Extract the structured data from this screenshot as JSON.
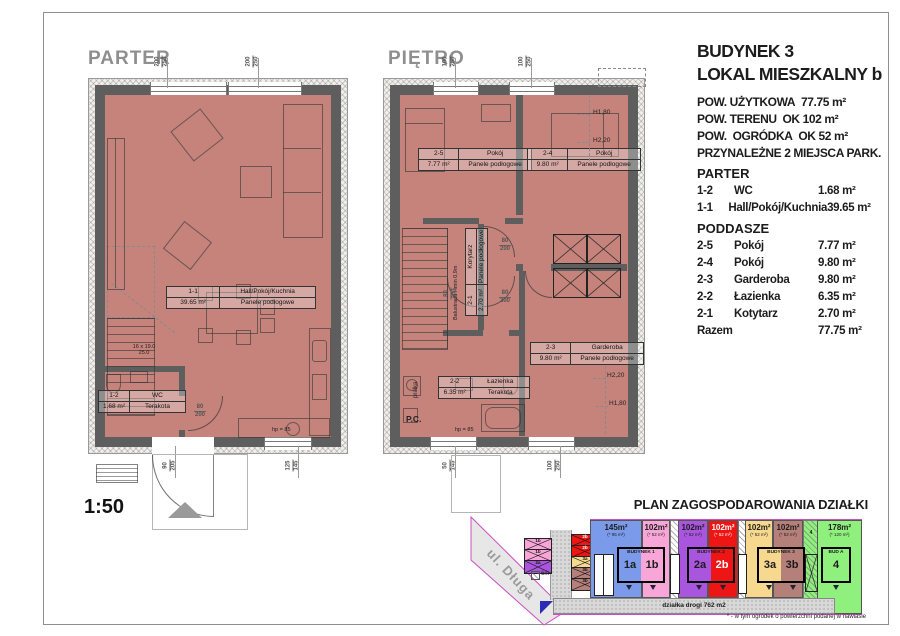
{
  "scale_label": "1:50",
  "colors": {
    "floor_fill": "#c5837c",
    "wall": "#5e5e5e",
    "boundary_magenta": "#cc4fc2",
    "parcel_blue": "#7b9bea",
    "parcel_pink": "#f8a6d8",
    "parcel_purple": "#aa55dd",
    "parcel_red": "#ee1515",
    "parcel_yellow": "#f6d98e",
    "parcel_brown": "#b57f7a",
    "parcel_green": "#8ff07d"
  },
  "parter": {
    "title": "PARTER",
    "rooms": {
      "hall": {
        "code": "1-1",
        "name": "Hall/Pokój/Kuchnia",
        "area": "39.65 m²",
        "finish": "Panele podłogowe"
      },
      "wc": {
        "code": "1-2",
        "name": "WC",
        "area": "1.68 m²",
        "finish": "Terakota"
      }
    },
    "dims": {
      "top1": {
        "t": "200",
        "b": "250"
      },
      "top2": {
        "t": "200",
        "b": "250"
      },
      "bottom1": {
        "t": "90",
        "b": "205"
      },
      "bottom2": {
        "t": "125",
        "b": "145"
      },
      "door_wc": {
        "t": "80",
        "b": "200"
      }
    },
    "stairs_note": {
      "line1": "16 x 19.0",
      "line2": "25.0"
    },
    "hp_label": "hp = 85"
  },
  "pietro": {
    "title": "PIĘTRO",
    "rooms": {
      "r25": {
        "code": "2-5",
        "name": "Pokój",
        "area": "7.77 m²",
        "finish": "Panele podłogowe"
      },
      "r24": {
        "code": "2-4",
        "name": "Pokój",
        "area": "9.80 m²",
        "finish": "Panele podłogowe"
      },
      "r23": {
        "code": "2-3",
        "name": "Garderoba",
        "area": "9.80 m²",
        "finish": "Panele podłogowe"
      },
      "r22": {
        "code": "2-2",
        "name": "Łazienka",
        "area": "6.35 m²",
        "finish": "Terakota"
      },
      "r21": {
        "code": "2-1",
        "name": "Korytarz",
        "area": "2.70 m²",
        "finish": "Panele podłogowe"
      }
    },
    "dims": {
      "top1": {
        "t": "100",
        "b": "250"
      },
      "top2": {
        "t": "100",
        "b": "250"
      },
      "bottom1": {
        "t": "50",
        "b": "145"
      },
      "bottom2": {
        "t": "100",
        "b": "250"
      },
      "door1": {
        "t": "80",
        "b": "200"
      },
      "door2": {
        "t": "80",
        "b": "200"
      },
      "door3": {
        "t": "80",
        "b": "200"
      }
    },
    "h_top1": "H1,80",
    "h_top2": "H2,20",
    "h_bot1": "H2,20",
    "h_bot2": "H1,80",
    "balustrada": "Balustrada Hmin 0,9m",
    "pralka": "pralka",
    "pc": "P.C.",
    "hp_label": "hp = 85"
  },
  "info": {
    "building": "BUDYNEK 3",
    "unit": "LOKAL MIESZKALNY b",
    "specs": [
      "POW. UŻYTKOWA  77.75 m²",
      "POW. TERENU  OK 102 m²",
      "POW.  OGRÓDKA  OK 52 m²",
      "PRZYNALEŻNE 2 MIEJSCA PARK."
    ],
    "section_parter": "PARTER",
    "rows_parter": [
      {
        "code": "1-2",
        "name": "WC",
        "area": "1.68 m²"
      },
      {
        "code": "1-1",
        "name": "Hall/Pokój/Kuchnia",
        "area": "39.65 m²"
      }
    ],
    "section_poddasze": "PODDASZE",
    "rows_poddasze": [
      {
        "code": "2-5",
        "name": "Pokój",
        "area": "7.77 m²"
      },
      {
        "code": "2-4",
        "name": "Pokój",
        "area": "9.80 m²"
      },
      {
        "code": "2-3",
        "name": "Garderoba",
        "area": "9.80 m²"
      },
      {
        "code": "2-2",
        "name": "Łazienka",
        "area": "6.35 m²"
      },
      {
        "code": "2-1",
        "name": "Kotytarz",
        "area": "2.70 m²"
      }
    ],
    "total_label": "Razem",
    "total_area": "77.75 m²"
  },
  "siteplan": {
    "title": "PLAN ZAGOSPODAROWANIA DZIAŁKI",
    "street": "ul. Długa",
    "road_label": "działka drogi 762 m2",
    "width_label": "6m",
    "footnote": "* - w tym ogródek o powierzchni podanej w nawiasie",
    "parcels": [
      {
        "area": "145m²",
        "sub": "(* 95 m²)"
      },
      {
        "area": "102m²",
        "sub": "(* 52 m²)"
      },
      {
        "area": "102m²",
        "sub": "(* 52 m²)"
      },
      {
        "area": "102m²",
        "sub": "(* 52 m²)"
      },
      {
        "area": "102m²",
        "sub": "(* 52 m²)"
      },
      {
        "area": "102m²",
        "sub": "(* 52 m²)"
      },
      {
        "area": "178m²",
        "sub": "(* 120 m²)"
      }
    ],
    "buildings": [
      {
        "name": "BUDYNEK 1",
        "u1": "1a",
        "u2": "1b"
      },
      {
        "name": "BUDYNEK 2",
        "u1": "2a",
        "u2": "2b"
      },
      {
        "name": "BUDYNEK 3",
        "u1": "3a",
        "u2": "3b"
      },
      {
        "name": "BUD A",
        "u1": "4"
      }
    ],
    "parking_left": [
      "1b",
      "1b",
      "2a"
    ],
    "parking_right": [
      "2b",
      "2b",
      "3a",
      "3b",
      "3b"
    ],
    "strip_unit": "4"
  }
}
